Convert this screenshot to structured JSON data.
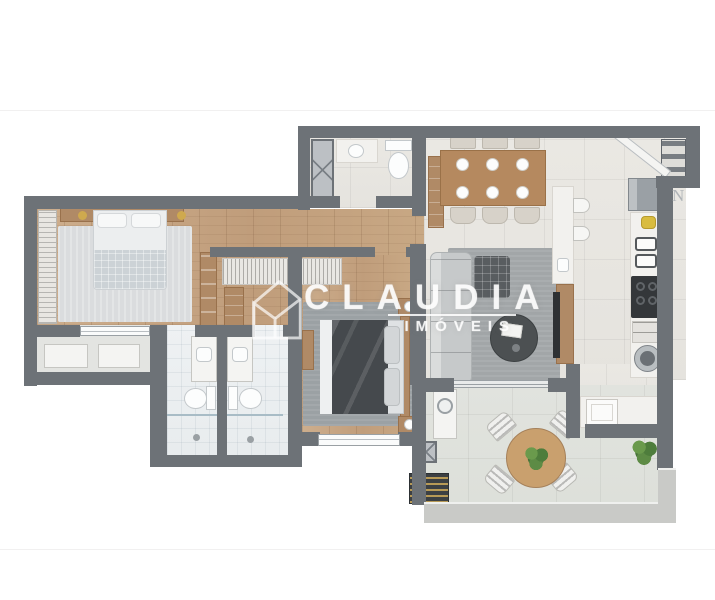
{
  "watermark": {
    "brand": "CLAUDIA",
    "tagline": "IMÓVEIS",
    "logo_icon": "house-outline-logo"
  },
  "compass": {
    "north_label": "N"
  },
  "palette": {
    "wall": "#6d7277",
    "wall_light": "#c9cac7",
    "wood_floor": "#c6a685",
    "tile_floor": "#e8e6e1",
    "bath_tile": "#edf0f2",
    "terrace_tile": "#e0e2dd",
    "rug_light": "#dadcde",
    "rug_gray": "#9ba1a4",
    "sofa": "#c6c9ca",
    "dark_bedding": "#45494d",
    "furniture_wood": "#b08a66",
    "dining_table_wood": "#b5895f",
    "marble": "#f2f1ee",
    "cooktop": "#35383b",
    "accent_yellow": "#d9bc3f",
    "plant_green": "#4e7d3c",
    "watermark_white": "rgba(255,255,255,0.78)"
  }
}
